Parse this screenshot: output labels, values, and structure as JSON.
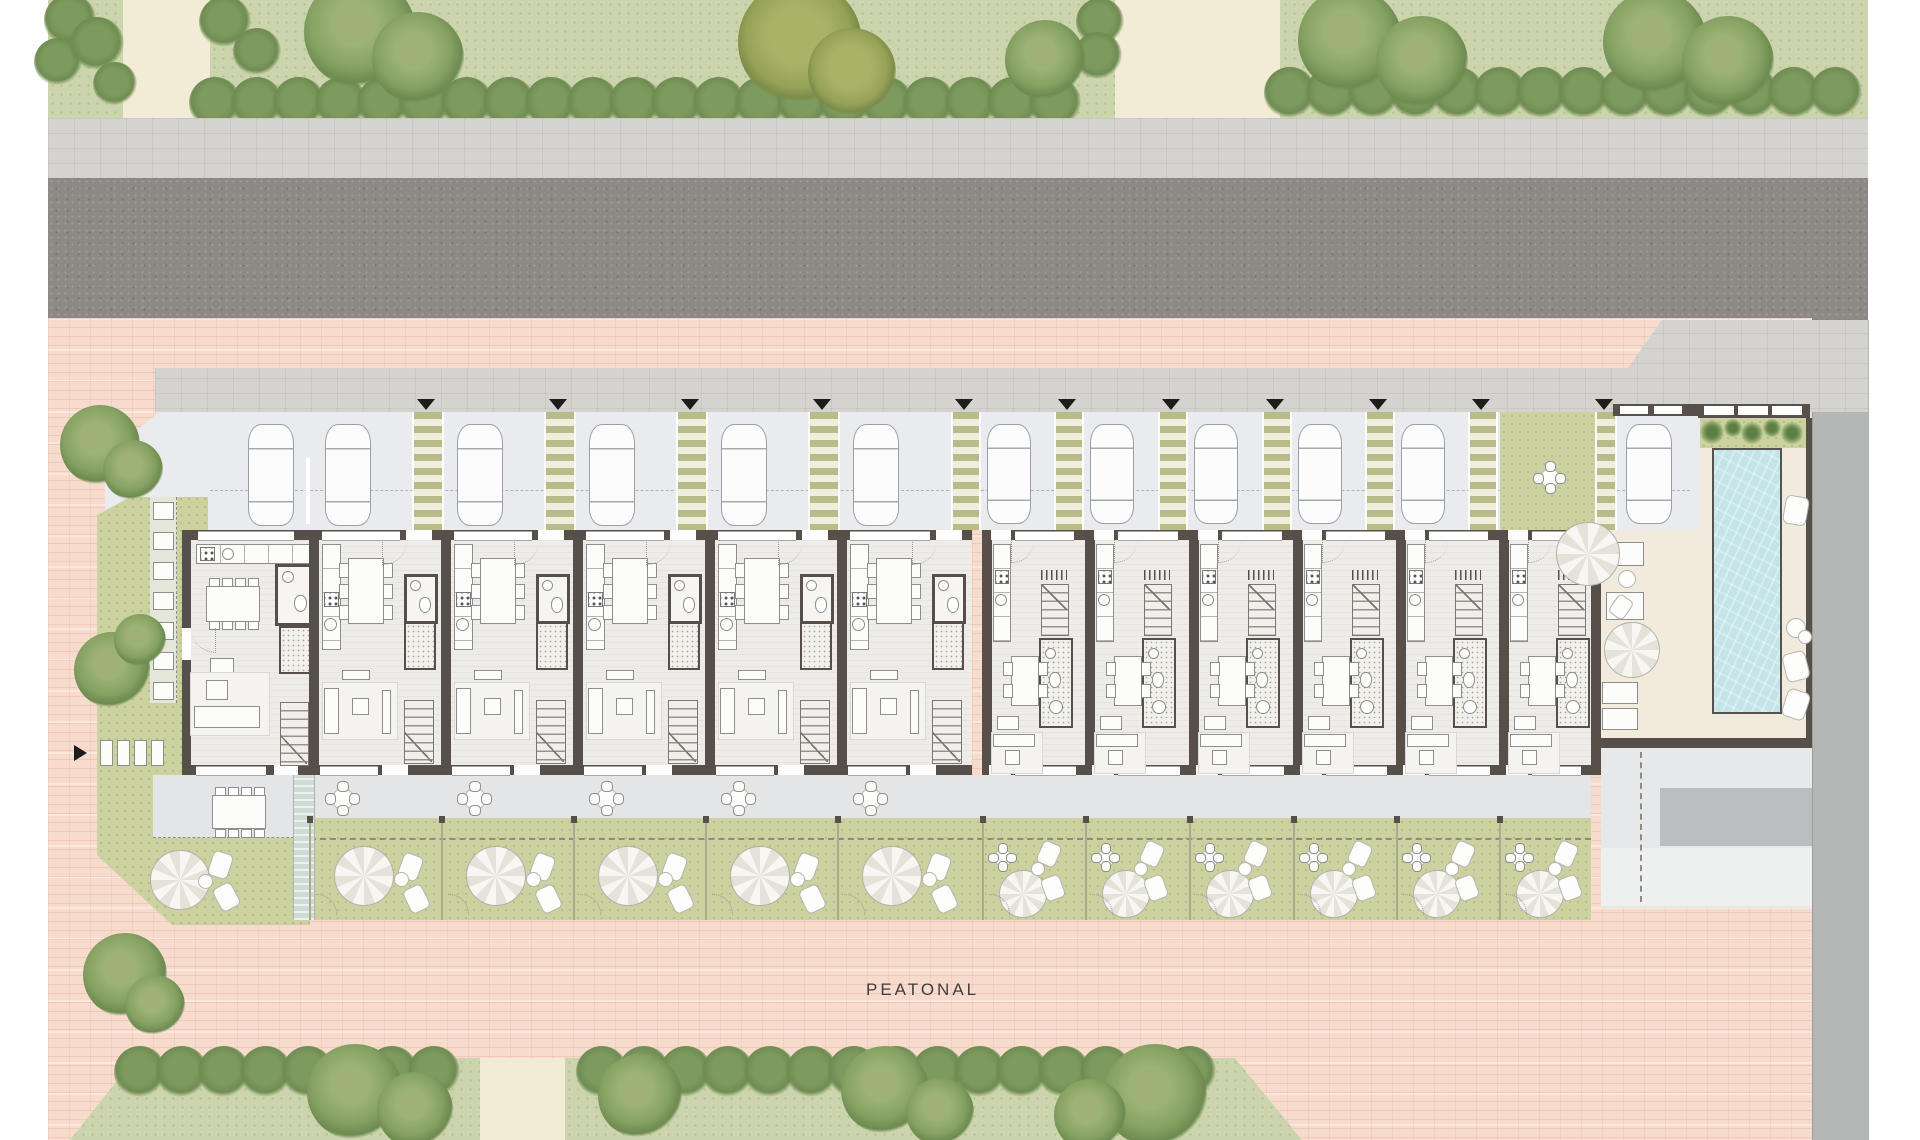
{
  "labels": {
    "pedestrian_street": "PEATONAL"
  },
  "palette": {
    "lawn": "#ccd4ad",
    "cream": "#f2ecd7",
    "sidewalk": "#d4d3cf",
    "asphalt": "#8d8984",
    "pink": "#f7dcce",
    "parking": "#e9ebee",
    "garden": "#cbd2a0",
    "terrace": "#e4e5e7",
    "floor": "#edece8",
    "wall": "#57504a",
    "deck": "#f0ebdc",
    "water": "#c3e4e8",
    "plaza": "#e6e8ea",
    "graystrip": "#b5b6b6",
    "hedge": "#7e9b5f",
    "tree": "#86a263",
    "pathgreen": "#b8bc8b"
  },
  "site": {
    "rows": [
      "park strip with trees",
      "sidewalk",
      "asphalt road",
      "sidewalk",
      "parking row",
      "row houses",
      "terraces",
      "private gardens",
      "pedestrian street",
      "park strip"
    ],
    "units": [
      {
        "id": "U01",
        "type": "corner",
        "x": 182,
        "w": 128,
        "car": true,
        "path": false
      },
      {
        "id": "U02",
        "type": "A",
        "x": 310,
        "w": 132,
        "car": true,
        "path": false
      },
      {
        "id": "U03",
        "type": "A",
        "x": 442,
        "w": 132,
        "car": true,
        "path": true
      },
      {
        "id": "U04",
        "type": "A",
        "x": 574,
        "w": 132,
        "car": true,
        "path": true
      },
      {
        "id": "U05",
        "type": "A",
        "x": 706,
        "w": 132,
        "car": true,
        "path": true
      },
      {
        "id": "U06",
        "type": "A",
        "x": 838,
        "w": 134,
        "car": true,
        "path": true
      },
      {
        "id": "U07",
        "type": "B",
        "x": 983,
        "w": 103,
        "car": true,
        "path": true
      },
      {
        "id": "U08",
        "type": "B",
        "x": 1086,
        "w": 104,
        "car": true,
        "path": true
      },
      {
        "id": "U09",
        "type": "B",
        "x": 1190,
        "w": 104,
        "car": true,
        "path": true
      },
      {
        "id": "U10",
        "type": "B",
        "x": 1294,
        "w": 103,
        "car": true,
        "path": true
      },
      {
        "id": "U11",
        "type": "B",
        "x": 1397,
        "w": 103,
        "car": true,
        "path": true
      },
      {
        "id": "U12",
        "type": "B",
        "x": 1500,
        "w": 91,
        "car": false,
        "path": true
      }
    ],
    "guest_parking": {
      "x": 1613,
      "car": true,
      "path_x": 1595
    },
    "pool": {
      "x": 1700,
      "y": 448,
      "w": 66,
      "h": 262
    },
    "car_count": 12,
    "entry_arrow_count": 11
  }
}
